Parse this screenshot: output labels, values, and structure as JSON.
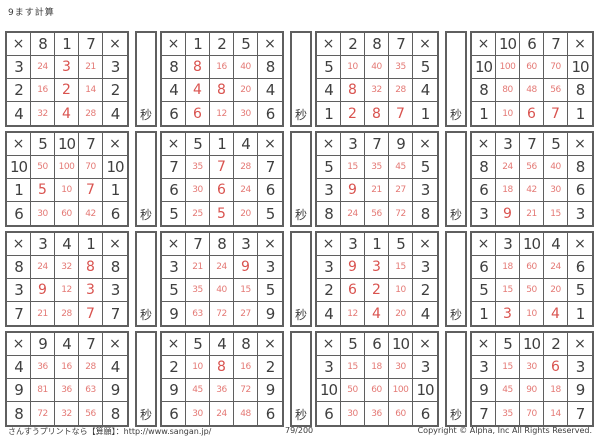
{
  "page": {
    "title": "9ます計算",
    "multiply_symbol": "×",
    "seconds_label": "秒",
    "footer_left": "さんすうプリントなら【算願】：http://www.sangan.jp/",
    "footer_center": "79/200",
    "footer_right": "Copyright © Alpha, Inc All Rights Reserved."
  },
  "colors": {
    "answer_red": "#d9534f",
    "answer_red_light": "#e47a76",
    "number_dark": "#3f3f3f",
    "border": "#5f5f5f"
  },
  "grids": [
    {
      "top": [
        "8",
        "1",
        "7"
      ],
      "rows": [
        {
          "left": "3",
          "answers": [
            "24",
            "3",
            "21"
          ]
        },
        {
          "left": "2",
          "answers": [
            "16",
            "2",
            "14"
          ]
        },
        {
          "left": "4",
          "answers": [
            "32",
            "4",
            "28"
          ]
        }
      ]
    },
    {
      "top": [
        "1",
        "2",
        "5"
      ],
      "rows": [
        {
          "left": "8",
          "answers": [
            "8",
            "16",
            "40"
          ]
        },
        {
          "left": "4",
          "answers": [
            "4",
            "8",
            "20"
          ]
        },
        {
          "left": "6",
          "answers": [
            "6",
            "12",
            "30"
          ]
        }
      ]
    },
    {
      "top": [
        "2",
        "8",
        "7"
      ],
      "rows": [
        {
          "left": "5",
          "answers": [
            "10",
            "40",
            "35"
          ]
        },
        {
          "left": "4",
          "answers": [
            "8",
            "32",
            "28"
          ]
        },
        {
          "left": "1",
          "answers": [
            "2",
            "8",
            "7"
          ]
        }
      ]
    },
    {
      "top": [
        "10",
        "6",
        "7"
      ],
      "rows": [
        {
          "left": "10",
          "answers": [
            "100",
            "60",
            "70"
          ]
        },
        {
          "left": "8",
          "answers": [
            "80",
            "48",
            "56"
          ]
        },
        {
          "left": "1",
          "answers": [
            "10",
            "6",
            "7"
          ]
        }
      ]
    },
    {
      "top": [
        "5",
        "10",
        "7"
      ],
      "rows": [
        {
          "left": "10",
          "answers": [
            "50",
            "100",
            "70"
          ]
        },
        {
          "left": "1",
          "answers": [
            "5",
            "10",
            "7"
          ]
        },
        {
          "left": "6",
          "answers": [
            "30",
            "60",
            "42"
          ]
        }
      ]
    },
    {
      "top": [
        "5",
        "1",
        "4"
      ],
      "rows": [
        {
          "left": "7",
          "answers": [
            "35",
            "7",
            "28"
          ]
        },
        {
          "left": "6",
          "answers": [
            "30",
            "6",
            "24"
          ]
        },
        {
          "left": "5",
          "answers": [
            "25",
            "5",
            "20"
          ]
        }
      ]
    },
    {
      "top": [
        "3",
        "7",
        "9"
      ],
      "rows": [
        {
          "left": "5",
          "answers": [
            "15",
            "35",
            "45"
          ]
        },
        {
          "left": "3",
          "answers": [
            "9",
            "21",
            "27"
          ]
        },
        {
          "left": "8",
          "answers": [
            "24",
            "56",
            "72"
          ]
        }
      ]
    },
    {
      "top": [
        "3",
        "7",
        "5"
      ],
      "rows": [
        {
          "left": "8",
          "answers": [
            "24",
            "56",
            "40"
          ]
        },
        {
          "left": "6",
          "answers": [
            "18",
            "42",
            "30"
          ]
        },
        {
          "left": "3",
          "answers": [
            "9",
            "21",
            "15"
          ]
        }
      ]
    },
    {
      "top": [
        "3",
        "4",
        "1"
      ],
      "rows": [
        {
          "left": "8",
          "answers": [
            "24",
            "32",
            "8"
          ]
        },
        {
          "left": "3",
          "answers": [
            "9",
            "12",
            "3"
          ]
        },
        {
          "left": "7",
          "answers": [
            "21",
            "28",
            "7"
          ]
        }
      ]
    },
    {
      "top": [
        "7",
        "8",
        "3"
      ],
      "rows": [
        {
          "left": "3",
          "answers": [
            "21",
            "24",
            "9"
          ]
        },
        {
          "left": "5",
          "answers": [
            "35",
            "40",
            "15"
          ]
        },
        {
          "left": "9",
          "answers": [
            "63",
            "72",
            "27"
          ]
        }
      ]
    },
    {
      "top": [
        "3",
        "1",
        "5"
      ],
      "rows": [
        {
          "left": "3",
          "answers": [
            "9",
            "3",
            "15"
          ]
        },
        {
          "left": "2",
          "answers": [
            "6",
            "2",
            "10"
          ]
        },
        {
          "left": "4",
          "answers": [
            "12",
            "4",
            "20"
          ]
        }
      ]
    },
    {
      "top": [
        "3",
        "10",
        "4"
      ],
      "rows": [
        {
          "left": "6",
          "answers": [
            "18",
            "60",
            "24"
          ]
        },
        {
          "left": "5",
          "answers": [
            "15",
            "50",
            "20"
          ]
        },
        {
          "left": "1",
          "answers": [
            "3",
            "10",
            "4"
          ]
        }
      ]
    },
    {
      "top": [
        "9",
        "4",
        "7"
      ],
      "rows": [
        {
          "left": "4",
          "answers": [
            "36",
            "16",
            "28"
          ]
        },
        {
          "left": "9",
          "answers": [
            "81",
            "36",
            "63"
          ]
        },
        {
          "left": "8",
          "answers": [
            "72",
            "32",
            "56"
          ]
        }
      ]
    },
    {
      "top": [
        "5",
        "4",
        "8"
      ],
      "rows": [
        {
          "left": "2",
          "answers": [
            "10",
            "8",
            "16"
          ]
        },
        {
          "left": "9",
          "answers": [
            "45",
            "36",
            "72"
          ]
        },
        {
          "left": "6",
          "answers": [
            "30",
            "24",
            "48"
          ]
        }
      ]
    },
    {
      "top": [
        "5",
        "6",
        "10"
      ],
      "rows": [
        {
          "left": "3",
          "answers": [
            "15",
            "18",
            "30"
          ]
        },
        {
          "left": "10",
          "answers": [
            "50",
            "60",
            "100"
          ]
        },
        {
          "left": "6",
          "answers": [
            "30",
            "36",
            "60"
          ]
        }
      ]
    },
    {
      "top": [
        "5",
        "10",
        "2"
      ],
      "rows": [
        {
          "left": "3",
          "answers": [
            "15",
            "30",
            "6"
          ]
        },
        {
          "left": "9",
          "answers": [
            "45",
            "90",
            "18"
          ]
        },
        {
          "left": "7",
          "answers": [
            "35",
            "70",
            "14"
          ]
        }
      ]
    }
  ]
}
